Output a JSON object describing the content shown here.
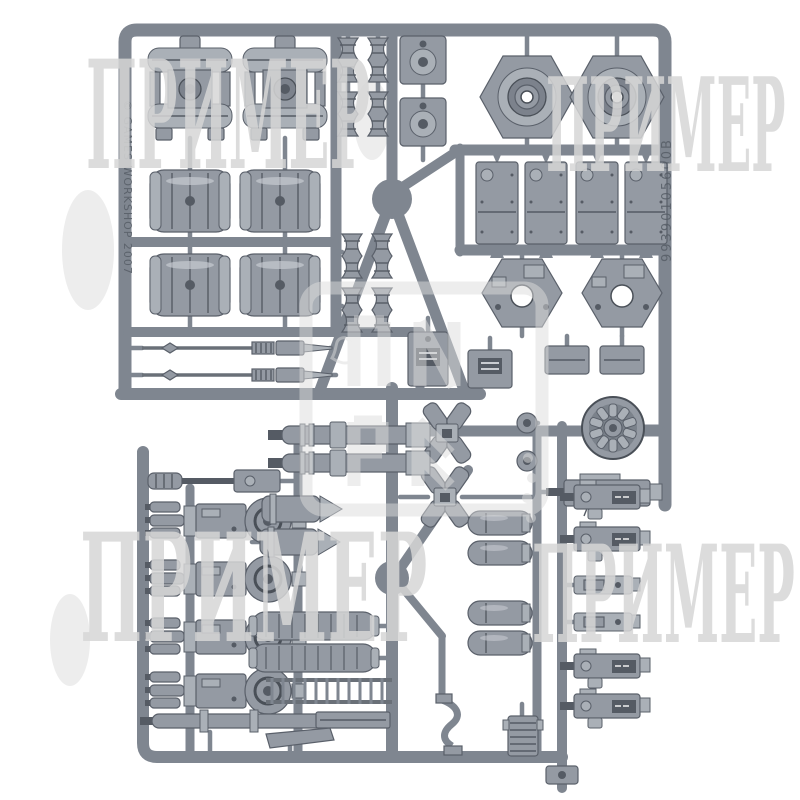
{
  "photo": {
    "subject": "plastic model sprue of tank accessory parts",
    "sprue_color": "#7f8690",
    "background_color": "#ffffff"
  },
  "watermark": {
    "text": "ПРИМЕР",
    "color": "#d8d8d8",
    "positions": [
      "top-left",
      "top-right",
      "bottom-left",
      "bottom-right"
    ]
  },
  "sprue_markings": {
    "copyright": "© GAMES WORKSHOP 2007",
    "part_code": "99390105600B"
  }
}
